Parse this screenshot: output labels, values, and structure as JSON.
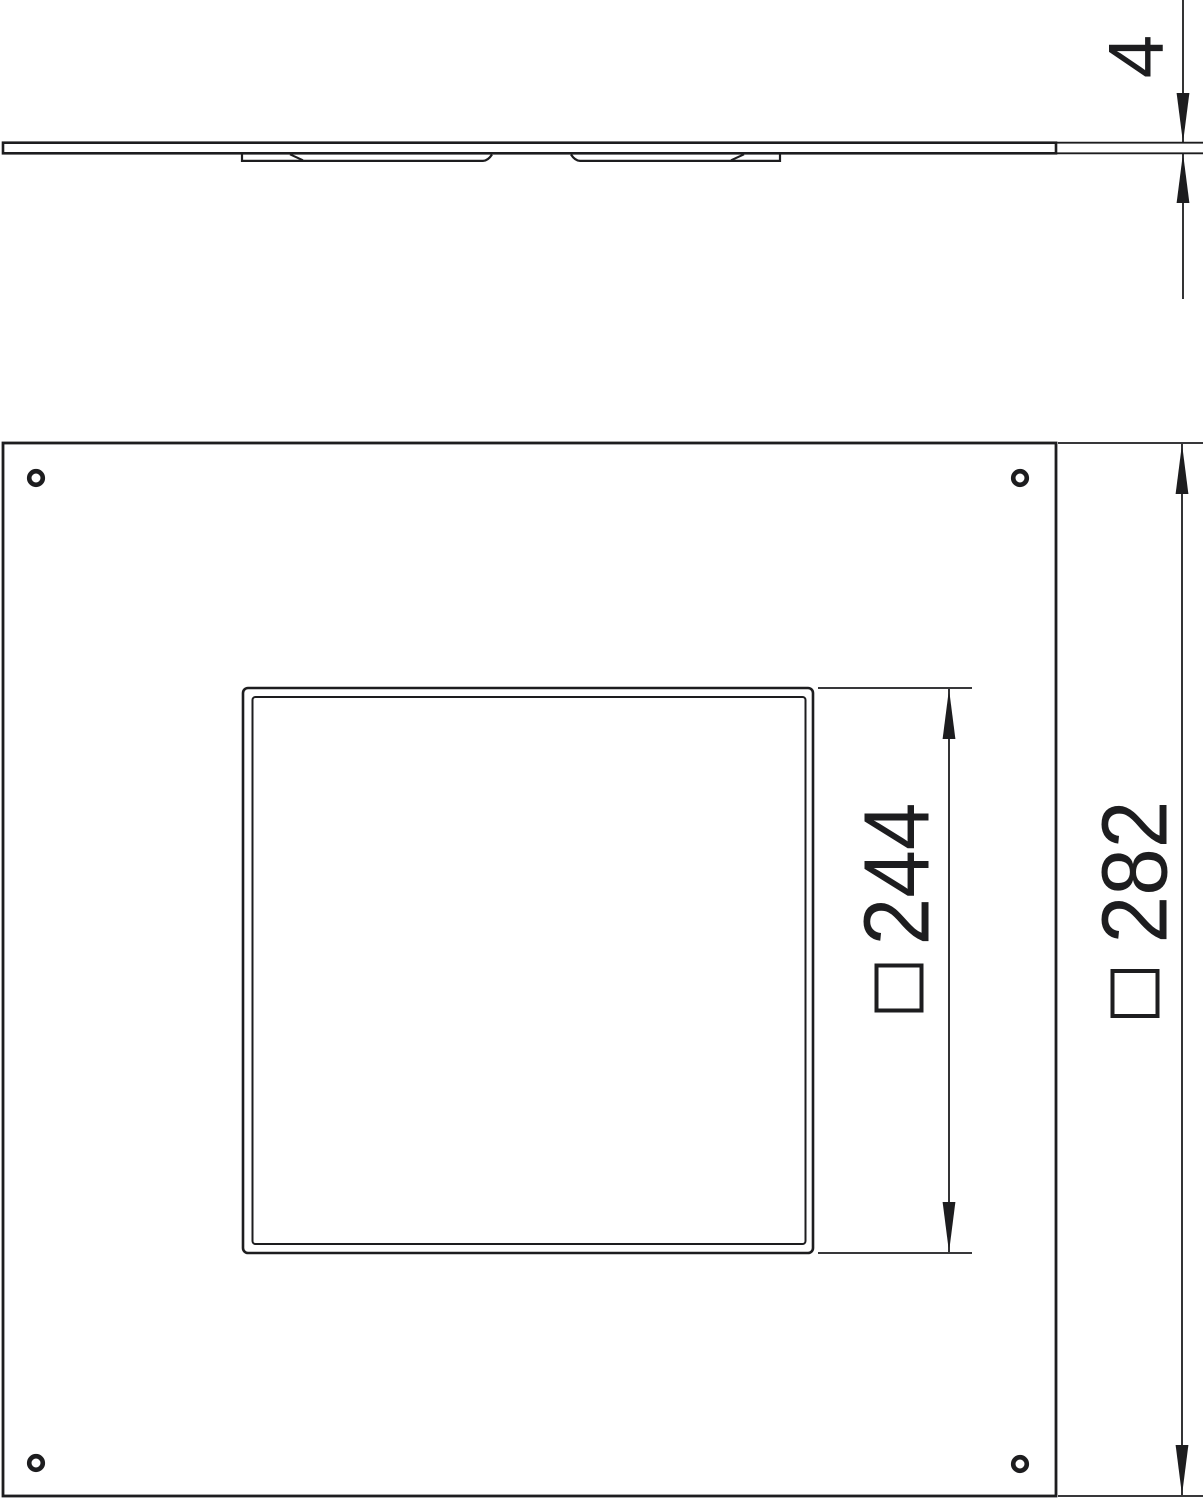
{
  "meta": {
    "drawing_kind": "technical-dimension-drawing",
    "background_color": "#ffffff",
    "line_color": "#1d1d1f"
  },
  "side_view": {
    "name": "plate side profile",
    "thickness": {
      "value": "4"
    }
  },
  "plan_view": {
    "name": "cover plate top view",
    "cutout": {
      "symbol": "square-outline-symbol",
      "value": "244"
    },
    "plate": {
      "symbol": "square-outline-symbol",
      "value": "282"
    },
    "screw_hole_count": 4
  }
}
